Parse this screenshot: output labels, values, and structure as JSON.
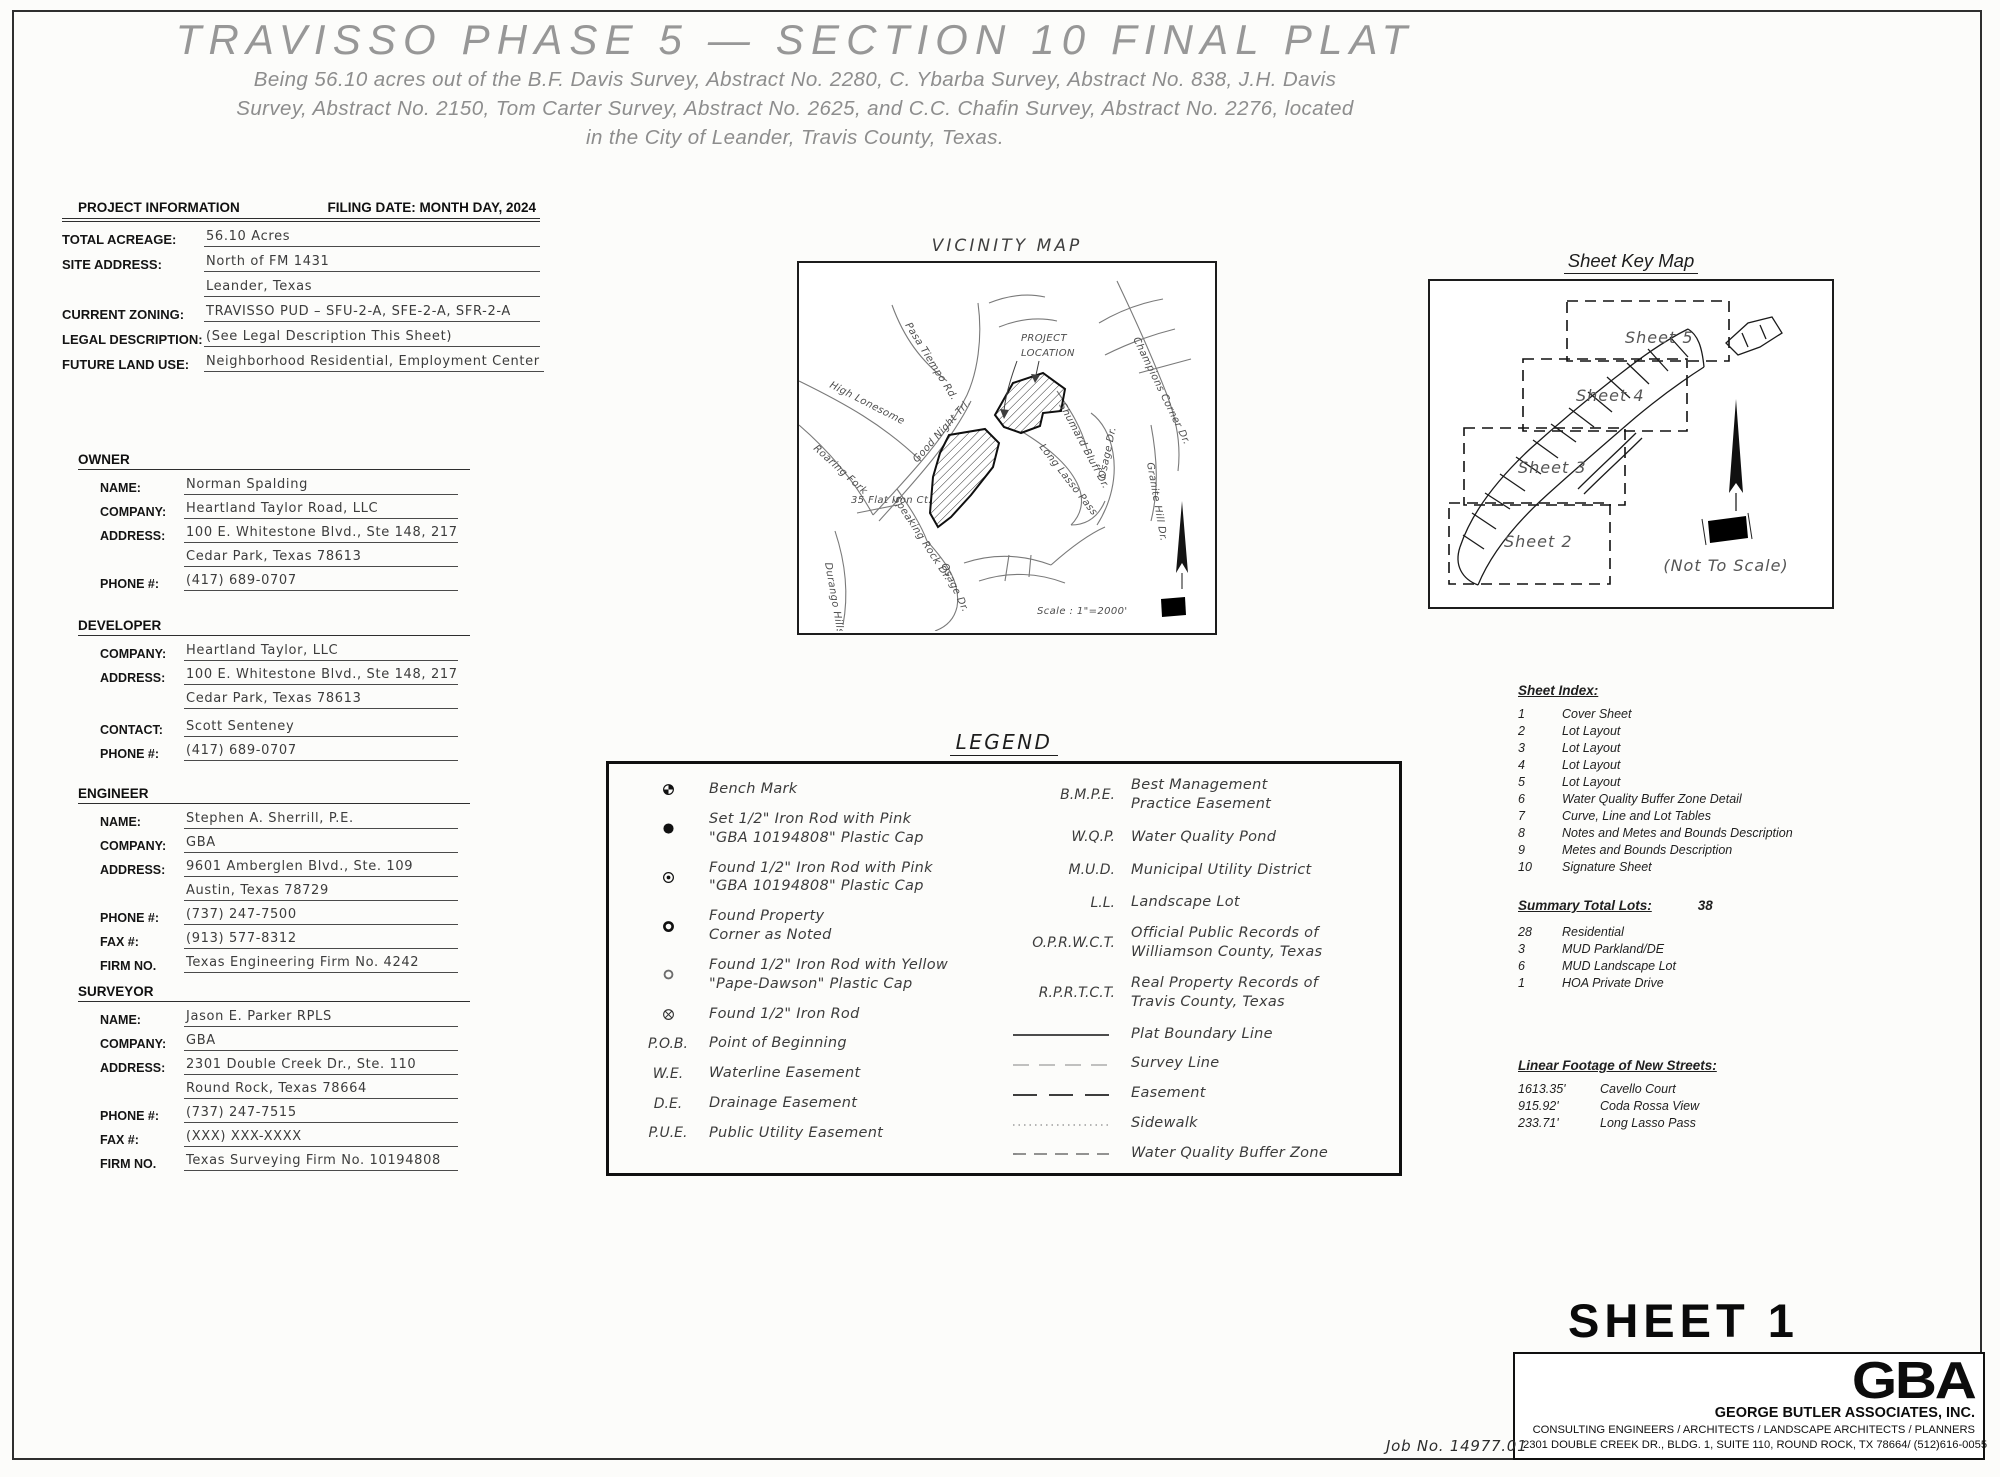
{
  "colors": {
    "ink": "#1a1a1a",
    "cad_gray": "#8f8f8f",
    "paper": "#fcfcfa"
  },
  "title": "TRAVISSO PHASE 5 — SECTION 10 FINAL PLAT",
  "subtitle": [
    "Being 56.10 acres out of the B.F. Davis Survey, Abstract No. 2280, C. Ybarba Survey, Abstract No. 838, J.H. Davis",
    "Survey, Abstract No. 2150, Tom Carter Survey, Abstract No. 2625, and C.C. Chafin Survey, Abstract No. 2276,  located",
    "in the City of Leander, Travis County, Texas."
  ],
  "project_info": {
    "heading": "PROJECT INFORMATION",
    "filing_date": "FILING DATE: MONTH DAY, 2024",
    "total_acreage_label": "TOTAL ACREAGE:",
    "total_acreage": "56.10 Acres",
    "site_address_label": "SITE ADDRESS:",
    "site_address_1": "North of FM 1431",
    "site_address_2": "Leander, Texas",
    "zoning_label": "CURRENT ZONING:",
    "zoning": "TRAVISSO PUD – SFU-2-A, SFE-2-A, SFR-2-A",
    "legal_label": "LEGAL DESCRIPTION:",
    "legal": "(See Legal Description This Sheet)",
    "landuse_label": "FUTURE LAND USE:",
    "landuse": "Neighborhood Residential, Employment Center"
  },
  "owner": {
    "heading": "OWNER",
    "name_label": "NAME:",
    "name": "Norman Spalding",
    "company_label": "COMPANY:",
    "company": "Heartland Taylor Road, LLC",
    "address_label": "ADDRESS:",
    "address_1": "100 E. Whitestone Blvd., Ste 148, 217",
    "address_2": "Cedar Park, Texas 78613",
    "phone_label": "PHONE #:",
    "phone": "(417) 689-0707"
  },
  "developer": {
    "heading": "DEVELOPER",
    "company_label": "COMPANY:",
    "company": "Heartland Taylor, LLC",
    "address_label": "ADDRESS:",
    "address_1": "100 E. Whitestone Blvd., Ste 148, 217",
    "address_2": "Cedar Park, Texas 78613",
    "contact_label": "CONTACT:",
    "contact": "Scott Senteney",
    "phone_label": "PHONE #:",
    "phone": "(417) 689-0707"
  },
  "engineer": {
    "heading": "ENGINEER",
    "name_label": "NAME:",
    "name": "Stephen A. Sherrill, P.E.",
    "company_label": "COMPANY:",
    "company": "GBA",
    "address_label": "ADDRESS:",
    "address_1": "9601 Amberglen Blvd., Ste. 109",
    "address_2": "Austin, Texas 78729",
    "phone_label": "PHONE #:",
    "phone": "(737) 247-7500",
    "fax_label": "FAX #:",
    "fax": "(913) 577-8312",
    "firm_label": "FIRM NO.",
    "firm": "Texas Engineering Firm No. 4242"
  },
  "surveyor": {
    "heading": "SURVEYOR",
    "name_label": "NAME:",
    "name": "Jason E. Parker RPLS",
    "company_label": "COMPANY:",
    "company": "GBA",
    "address_label": "ADDRESS:",
    "address_1": "2301 Double Creek Dr., Ste. 110",
    "address_2": "Round Rock, Texas 78664",
    "phone_label": "PHONE #:",
    "phone": "(737) 247-7515",
    "fax_label": "FAX #:",
    "fax": "(XXX) XXX-XXXX",
    "firm_label": "FIRM NO.",
    "firm": "Texas Surveying Firm No. 10194808"
  },
  "vicinity_map": {
    "title": "VICINITY MAP",
    "project_location_1": "PROJECT",
    "project_location_2": "LOCATION",
    "scale": "Scale : 1\"=2000'",
    "labels": {
      "pasa_tiempo": "Pasa Tiempo Rd.",
      "high_lonesome": "High Lonesome",
      "good_night": "Good Night Trl.",
      "roaring_fork": "Roaring Fork",
      "speaking_rock": "Speaking Rock Dr.",
      "flat_iron": "35 Flat Iron Ct.",
      "durango_hills": "Durango Hills Dr.",
      "osage_left": "Osage Dr.",
      "osage_right": "Osage Dr.",
      "long_lasso": "Long Lasso Pass",
      "champions": "Champions Corner Dr.",
      "shumard": "Shumard Bluff Dr.",
      "granite": "Granite Hill Dr."
    }
  },
  "sheet_key_map": {
    "title": "Sheet Key Map",
    "sheets": [
      "Sheet 5",
      "Sheet 4",
      "Sheet 3",
      "Sheet 2"
    ],
    "not_to_scale": "(Not To Scale)"
  },
  "legend": {
    "title": "LEGEND",
    "left": [
      {
        "l1": "Bench Mark",
        "l2": ""
      },
      {
        "l1": "Set 1/2\" Iron Rod with Pink",
        "l2": "\"GBA 10194808\" Plastic Cap"
      },
      {
        "l1": "Found 1/2\" Iron Rod with Pink",
        "l2": "\"GBA 10194808\" Plastic Cap"
      },
      {
        "l1": "Found Property",
        "l2": "Corner as Noted"
      },
      {
        "l1": "Found 1/2\" Iron Rod with Yellow",
        "l2": "\"Pape-Dawson\" Plastic Cap"
      },
      {
        "l1": "Found 1/2\" Iron Rod",
        "l2": ""
      },
      {
        "abbr": "P.O.B.",
        "l1": "Point of Beginning",
        "l2": ""
      },
      {
        "abbr": "W.E.",
        "l1": "Waterline Easement",
        "l2": ""
      },
      {
        "abbr": "D.E.",
        "l1": "Drainage Easement",
        "l2": ""
      },
      {
        "abbr": "P.U.E.",
        "l1": "Public Utility Easement",
        "l2": ""
      }
    ],
    "right": [
      {
        "abbr": "B.M.P.E.",
        "l1": "Best Management",
        "l2": "Practice Easement"
      },
      {
        "abbr": "W.Q.P.",
        "l1": "Water Quality Pond",
        "l2": ""
      },
      {
        "abbr": "M.U.D.",
        "l1": "Municipal Utility District",
        "l2": ""
      },
      {
        "abbr": "L.L.",
        "l1": "Landscape Lot",
        "l2": ""
      },
      {
        "abbr": "O.P.R.W.C.T.",
        "l1": "Official Public Records of",
        "l2": "Williamson County, Texas"
      },
      {
        "abbr": "R.P.R.T.C.T.",
        "l1": "Real Property Records of",
        "l2": "Travis County, Texas"
      },
      {
        "l1": "Plat Boundary Line",
        "l2": ""
      },
      {
        "l1": "Survey Line",
        "l2": ""
      },
      {
        "l1": "Easement",
        "l2": ""
      },
      {
        "l1": "Sidewalk",
        "l2": ""
      },
      {
        "l1": "Water Quality Buffer Zone",
        "l2": ""
      }
    ]
  },
  "sheet_index": {
    "heading": "Sheet Index:",
    "items": [
      {
        "num": "1",
        "label": "Cover Sheet"
      },
      {
        "num": "2",
        "label": "Lot Layout"
      },
      {
        "num": "3",
        "label": "Lot Layout"
      },
      {
        "num": "4",
        "label": "Lot Layout"
      },
      {
        "num": "5",
        "label": "Lot Layout"
      },
      {
        "num": "6",
        "label": "Water Quality Buffer Zone Detail"
      },
      {
        "num": "7",
        "label": "Curve, Line and Lot Tables"
      },
      {
        "num": "8",
        "label": "Notes and Metes and Bounds Description"
      },
      {
        "num": "9",
        "label": "Metes and Bounds Description"
      },
      {
        "num": "10",
        "label": "Signature Sheet"
      }
    ]
  },
  "summary": {
    "heading": "Summary Total Lots:",
    "total": "38",
    "items": [
      {
        "num": "28",
        "label": "Residential"
      },
      {
        "num": "3",
        "label": "MUD Parkland/DE"
      },
      {
        "num": "6",
        "label": "MUD Landscape Lot"
      },
      {
        "num": "1",
        "label": "HOA Private Drive"
      }
    ]
  },
  "streets": {
    "heading": "Linear Footage of New Streets:",
    "items": [
      {
        "len": "1613.35'",
        "name": "Cavello Court"
      },
      {
        "len": "915.92'",
        "name": "Coda Rossa View"
      },
      {
        "len": "233.71'",
        "name": "Long Lasso Pass"
      }
    ]
  },
  "footer": {
    "sheet_label": "SHEET 1",
    "job_no": "Job No. 14977.01",
    "logo": "GBA",
    "firm_name": "GEORGE BUTLER ASSOCIATES, INC.",
    "firm_line1": "CONSULTING ENGINEERS / ARCHITECTS / LANDSCAPE ARCHITECTS / PLANNERS",
    "firm_line2": "2301 DOUBLE CREEK DR., BLDG. 1, SUITE 110, ROUND ROCK, TX 78664/ (512)616-0055"
  }
}
